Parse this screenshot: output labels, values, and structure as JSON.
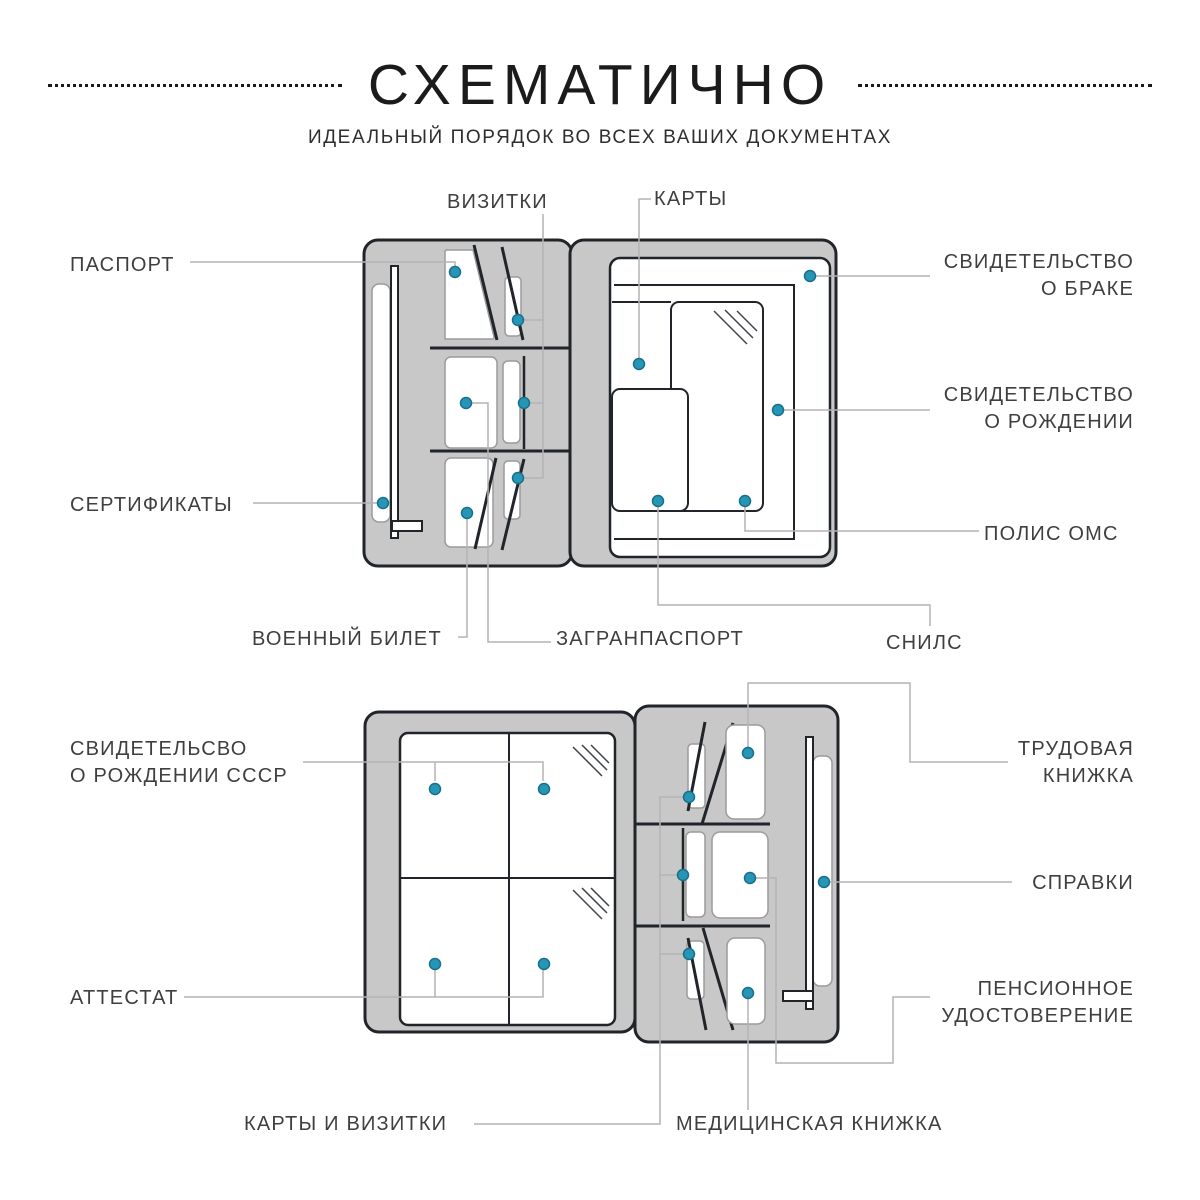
{
  "header": {
    "title": "СХЕМАТИЧНО",
    "subtitle": "ИДЕАЛЬНЫЙ ПОРЯДОК ВО ВСЕХ ВАШИХ ДОКУМЕНТАХ"
  },
  "colors": {
    "organizer_fill": "#c8c8c8",
    "outline": "#212529",
    "pocket_outline": "#9b9b9b",
    "leader_line": "#b4b4b4",
    "marker_dot_fill": "#2795b5",
    "marker_dot_stroke": "#17708a",
    "label_text": "#3f3f3f",
    "title_text": "#1b1b1b"
  },
  "top_diagram": {
    "labels": {
      "passport": "ПАСПОРТ",
      "certificates": "СЕРТИФИКАТЫ",
      "business_cards": "ВИЗИТКИ",
      "cards": "КАРТЫ",
      "marriage_certificate": "СВИДЕТЕЛЬСТВО\nО БРАКЕ",
      "birth_certificate": "СВИДЕТЕЛЬСТВО\nО РОЖДЕНИИ",
      "polis_oms": "ПОЛИС ОМС",
      "military_id": "ВОЕННЫЙ БИЛЕТ",
      "foreign_passport": "ЗАГРАНПАСПОРТ",
      "snils": "СНИЛС"
    }
  },
  "bottom_diagram": {
    "labels": {
      "ussr_birth_certificate": "СВИДЕТЕЛЬСВО\nО РОЖДЕНИИ СССР",
      "attestat": "АТТЕСТАТ",
      "work_record_book": "ТРУДОВАЯ\nКНИЖКА",
      "spravki": "СПРАВКИ",
      "pension_certificate": "ПЕНСИОННОЕ\nУДОСТОВЕРЕНИЕ",
      "cards_and_business_cards": "КАРТЫ И ВИЗИТКИ",
      "medical_book": "МЕДИЦИНСКАЯ КНИЖКА"
    }
  }
}
